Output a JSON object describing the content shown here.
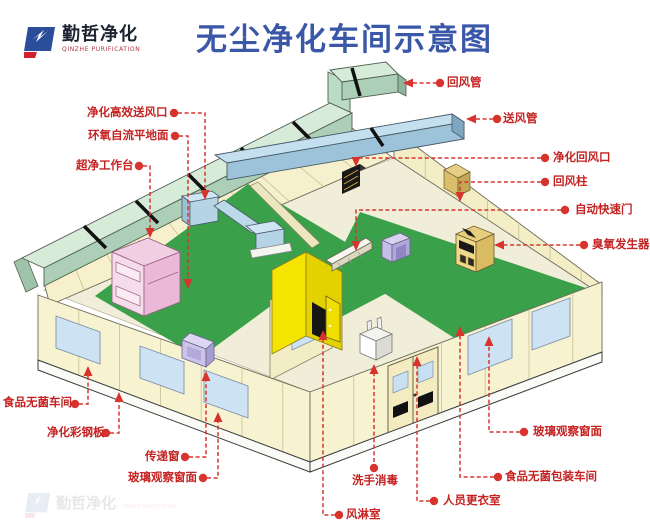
{
  "header": {
    "logo_name": "勤哲净化",
    "logo_subtitle": "QINZHE PURIFICATION",
    "title": "无尘净化车间示意图"
  },
  "callouts": {
    "supply_outlet": "净化高效送风口",
    "epoxy_floor": "环氧自流平地面",
    "clean_bench": "超净工作台",
    "aseptic_workshop": "食品无菌车间",
    "steel_panel": "净化彩钢板",
    "pass_window": "传递窗",
    "glass_window_left": "玻璃观察窗面",
    "return_duct": "回风管",
    "supply_duct": "送风管",
    "return_inlet": "净化回风口",
    "return_column": "回风柱",
    "auto_door": "自动快速门",
    "ozone_generator": "臭氧发生器",
    "glass_window_right": "玻璃观察窗面",
    "packaging_workshop": "食品无菌包装车间",
    "changing_room": "人员更衣室",
    "hand_wash": "洗手消毒",
    "air_shower": "风淋室"
  },
  "colors": {
    "title_blue": "#3a57a8",
    "callout_red": "#c52222",
    "leader_red": "#d8342e",
    "wall_cream": "#f8f3d4",
    "floor_green": "#3ba04a",
    "duct_sage": "#d7ebd9",
    "duct_blue": "#c4e0ef",
    "air_shower_yellow": "#f4e400",
    "bench_pink": "#f2cee2",
    "window_blue": "#cde3f4",
    "logo_blue": "#2b4e9b",
    "logo_red": "#d42030"
  }
}
